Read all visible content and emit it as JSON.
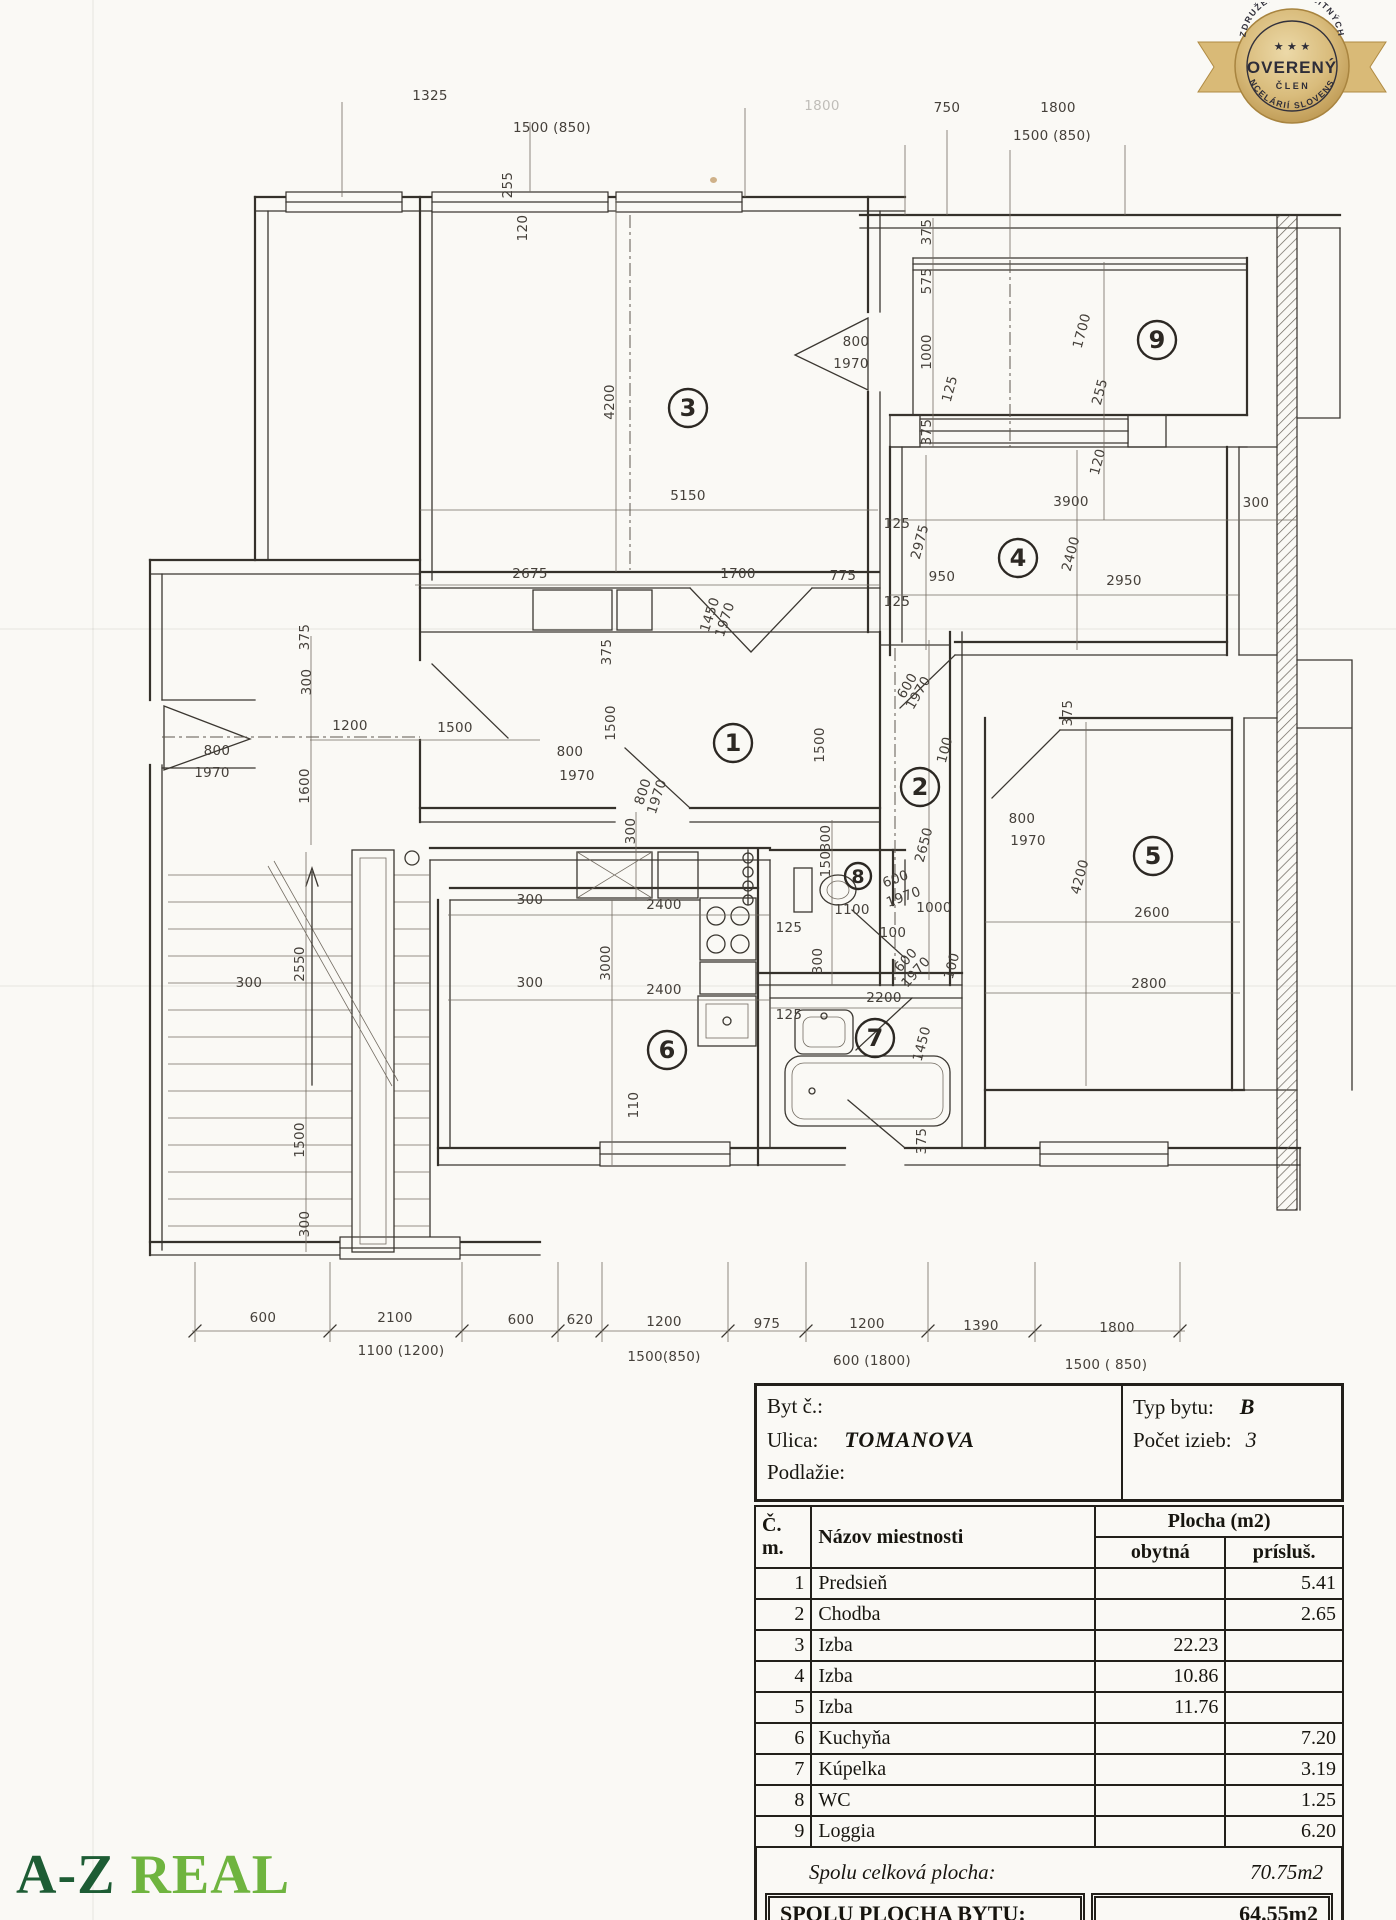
{
  "badge": {
    "arc_top": "ZDRUŽENIE REALITNÝCH",
    "arc_bottom": "KANCELÁRIÍ SLOVENSKA",
    "stars": "★ ★ ★",
    "title": "OVERENÝ",
    "subtitle": "ČLEN",
    "gold": "#cfa95f",
    "text_color": "#2e2d38"
  },
  "logo": {
    "part1": "A-Z",
    "part2": "REAL",
    "color1": "#1d5c34",
    "color2": "#6fb43f"
  },
  "plan": {
    "rooms": [
      {
        "n": "1",
        "x": 733,
        "y": 743
      },
      {
        "n": "2",
        "x": 920,
        "y": 787
      },
      {
        "n": "3",
        "x": 688,
        "y": 408
      },
      {
        "n": "4",
        "x": 1018,
        "y": 558
      },
      {
        "n": "5",
        "x": 1153,
        "y": 856
      },
      {
        "n": "6",
        "x": 667,
        "y": 1050
      },
      {
        "n": "7",
        "x": 875,
        "y": 1038
      },
      {
        "n": "8",
        "x": 858,
        "y": 876,
        "r": 13
      },
      {
        "n": "9",
        "x": 1157,
        "y": 340
      }
    ],
    "labels": [
      {
        "t": "1325",
        "x": 430,
        "y": 100
      },
      {
        "t": "1500 (850)",
        "x": 552,
        "y": 132
      },
      {
        "t": "1800",
        "x": 822,
        "y": 110,
        "f": 1
      },
      {
        "t": "750",
        "x": 947,
        "y": 112
      },
      {
        "t": "1800",
        "x": 1058,
        "y": 112
      },
      {
        "t": "1500 (850)",
        "x": 1052,
        "y": 140
      },
      {
        "t": "255",
        "x": 512,
        "y": 185,
        "r": -90
      },
      {
        "t": "120",
        "x": 527,
        "y": 228,
        "r": -90
      },
      {
        "t": "4200",
        "x": 614,
        "y": 402,
        "r": -90
      },
      {
        "t": "5150",
        "x": 688,
        "y": 500
      },
      {
        "t": "2675",
        "x": 530,
        "y": 578
      },
      {
        "t": "1700",
        "x": 738,
        "y": 578
      },
      {
        "t": "775",
        "x": 843,
        "y": 580
      },
      {
        "t": "1450",
        "x": 714,
        "y": 616,
        "r": -72
      },
      {
        "t": "1970",
        "x": 729,
        "y": 621,
        "r": -72
      },
      {
        "t": "375",
        "x": 611,
        "y": 652,
        "r": -90
      },
      {
        "t": "375",
        "x": 931,
        "y": 232,
        "r": -90
      },
      {
        "t": "575",
        "x": 931,
        "y": 281,
        "r": -90
      },
      {
        "t": "800",
        "x": 856,
        "y": 346
      },
      {
        "t": "1970",
        "x": 851,
        "y": 368
      },
      {
        "t": "1000",
        "x": 931,
        "y": 352,
        "r": -90
      },
      {
        "t": "125",
        "x": 954,
        "y": 390,
        "r": -75
      },
      {
        "t": "375",
        "x": 931,
        "y": 432,
        "r": -90
      },
      {
        "t": "1700",
        "x": 1086,
        "y": 332,
        "r": -75
      },
      {
        "t": "255",
        "x": 1104,
        "y": 393,
        "r": -75
      },
      {
        "t": "120",
        "x": 1102,
        "y": 463,
        "r": -75
      },
      {
        "t": "3900",
        "x": 1071,
        "y": 506
      },
      {
        "t": "300",
        "x": 1256,
        "y": 507
      },
      {
        "t": "125",
        "x": 897,
        "y": 528
      },
      {
        "t": "2975",
        "x": 924,
        "y": 543,
        "r": -75
      },
      {
        "t": "2400",
        "x": 1075,
        "y": 555,
        "r": -75
      },
      {
        "t": "950",
        "x": 942,
        "y": 581
      },
      {
        "t": "2950",
        "x": 1124,
        "y": 585
      },
      {
        "t": "125",
        "x": 897,
        "y": 606
      },
      {
        "t": "375",
        "x": 1072,
        "y": 713,
        "r": -90
      },
      {
        "t": "1200",
        "x": 350,
        "y": 730
      },
      {
        "t": "1500",
        "x": 455,
        "y": 732
      },
      {
        "t": "800",
        "x": 217,
        "y": 755
      },
      {
        "t": "1970",
        "x": 212,
        "y": 777
      },
      {
        "t": "1600",
        "x": 309,
        "y": 786,
        "r": -90
      },
      {
        "t": "800",
        "x": 570,
        "y": 756
      },
      {
        "t": "1970",
        "x": 577,
        "y": 780
      },
      {
        "t": "1500",
        "x": 615,
        "y": 723,
        "r": -90
      },
      {
        "t": "1500",
        "x": 824,
        "y": 745,
        "r": -90
      },
      {
        "t": "800",
        "x": 647,
        "y": 793,
        "r": -72
      },
      {
        "t": "1970",
        "x": 661,
        "y": 798,
        "r": -72
      },
      {
        "t": "300",
        "x": 635,
        "y": 831,
        "r": -90
      },
      {
        "t": "300",
        "x": 830,
        "y": 838,
        "r": -90
      },
      {
        "t": "150",
        "x": 830,
        "y": 864,
        "r": -90
      },
      {
        "t": "600",
        "x": 911,
        "y": 688,
        "r": -60
      },
      {
        "t": "1970",
        "x": 922,
        "y": 695,
        "r": -60
      },
      {
        "t": "100",
        "x": 949,
        "y": 751,
        "r": -75
      },
      {
        "t": "2650",
        "x": 928,
        "y": 846,
        "r": -75
      },
      {
        "t": "800",
        "x": 1022,
        "y": 823
      },
      {
        "t": "1970",
        "x": 1028,
        "y": 845
      },
      {
        "t": "4200",
        "x": 1084,
        "y": 878,
        "r": -75
      },
      {
        "t": "2600",
        "x": 1152,
        "y": 917
      },
      {
        "t": "2800",
        "x": 1149,
        "y": 988
      },
      {
        "t": "300",
        "x": 530,
        "y": 904
      },
      {
        "t": "2400",
        "x": 664,
        "y": 909
      },
      {
        "t": "3000",
        "x": 610,
        "y": 963,
        "r": -90
      },
      {
        "t": "300",
        "x": 530,
        "y": 987
      },
      {
        "t": "2400",
        "x": 664,
        "y": 994
      },
      {
        "t": "125",
        "x": 789,
        "y": 932
      },
      {
        "t": "1100",
        "x": 852,
        "y": 914
      },
      {
        "t": "600",
        "x": 897,
        "y": 883,
        "r": -20
      },
      {
        "t": "1970",
        "x": 905,
        "y": 901,
        "r": -20
      },
      {
        "t": "1000",
        "x": 934,
        "y": 912
      },
      {
        "t": "100",
        "x": 893,
        "y": 937
      },
      {
        "t": "300",
        "x": 822,
        "y": 961,
        "r": -90
      },
      {
        "t": "600",
        "x": 909,
        "y": 963,
        "r": -48
      },
      {
        "t": "1970",
        "x": 919,
        "y": 975,
        "r": -48
      },
      {
        "t": "100",
        "x": 956,
        "y": 967,
        "r": -75
      },
      {
        "t": "2200",
        "x": 884,
        "y": 1002
      },
      {
        "t": "125",
        "x": 789,
        "y": 1019
      },
      {
        "t": "1450",
        "x": 926,
        "y": 1045,
        "r": -75
      },
      {
        "t": "375",
        "x": 926,
        "y": 1141,
        "r": -90
      },
      {
        "t": "110",
        "x": 638,
        "y": 1105,
        "r": -90
      },
      {
        "t": "375",
        "x": 309,
        "y": 637,
        "r": -90
      },
      {
        "t": "300",
        "x": 311,
        "y": 682,
        "r": -90
      },
      {
        "t": "2550",
        "x": 304,
        "y": 964,
        "r": -90
      },
      {
        "t": "300",
        "x": 249,
        "y": 987
      },
      {
        "t": "1500",
        "x": 304,
        "y": 1140,
        "r": -90
      },
      {
        "t": "300",
        "x": 309,
        "y": 1224,
        "r": -90
      },
      {
        "t": "600",
        "x": 263,
        "y": 1322
      },
      {
        "t": "2100",
        "x": 395,
        "y": 1322
      },
      {
        "t": "600",
        "x": 521,
        "y": 1324
      },
      {
        "t": "620",
        "x": 580,
        "y": 1324
      },
      {
        "t": "1200",
        "x": 664,
        "y": 1326
      },
      {
        "t": "975",
        "x": 767,
        "y": 1328
      },
      {
        "t": "1200",
        "x": 867,
        "y": 1328
      },
      {
        "t": "1390",
        "x": 981,
        "y": 1330
      },
      {
        "t": "1800",
        "x": 1117,
        "y": 1332
      },
      {
        "t": "1100 (1200)",
        "x": 401,
        "y": 1355
      },
      {
        "t": "1500(850)",
        "x": 664,
        "y": 1361
      },
      {
        "t": "600 (1800)",
        "x": 872,
        "y": 1365
      },
      {
        "t": "1500 ( 850)",
        "x": 1106,
        "y": 1369
      }
    ]
  },
  "table": {
    "info": {
      "byt_label": "Byt č.:",
      "ulica_label": "Ulica:",
      "ulica_value": "TOMANOVA",
      "podlazie_label": "Podlažie:",
      "typ_label": "Typ bytu:",
      "typ_value": "B",
      "pocet_label": "Počet izieb:",
      "pocet_value": "3"
    },
    "plocha_header": "Plocha  (m2)",
    "col_cm": "Č. m.",
    "col_nazov": "Názov miestnosti",
    "col_obytna": "obytná",
    "col_prislus": "prísluš.",
    "rows": [
      {
        "c": "1",
        "n": "Predsieň",
        "o": "",
        "p": "5.41"
      },
      {
        "c": "2",
        "n": "Chodba",
        "o": "",
        "p": "2.65"
      },
      {
        "c": "3",
        "n": "Izba",
        "o": "22.23",
        "p": ""
      },
      {
        "c": "4",
        "n": "Izba",
        "o": "10.86",
        "p": ""
      },
      {
        "c": "5",
        "n": "Izba",
        "o": "11.76",
        "p": ""
      },
      {
        "c": "6",
        "n": "Kuchyňa",
        "o": "",
        "p": "7.20"
      },
      {
        "c": "7",
        "n": "Kúpelka",
        "o": "",
        "p": "3.19"
      },
      {
        "c": "8",
        "n": "WC",
        "o": "",
        "p": "1.25"
      },
      {
        "c": "9",
        "n": "Loggia",
        "o": "",
        "p": "6.20"
      }
    ],
    "total1_label": "Spolu celková plocha:",
    "total1_value": "70.75m2",
    "total2_label": "SPOLU PLOCHA BYTU:",
    "total2_value": "64.55m2"
  }
}
